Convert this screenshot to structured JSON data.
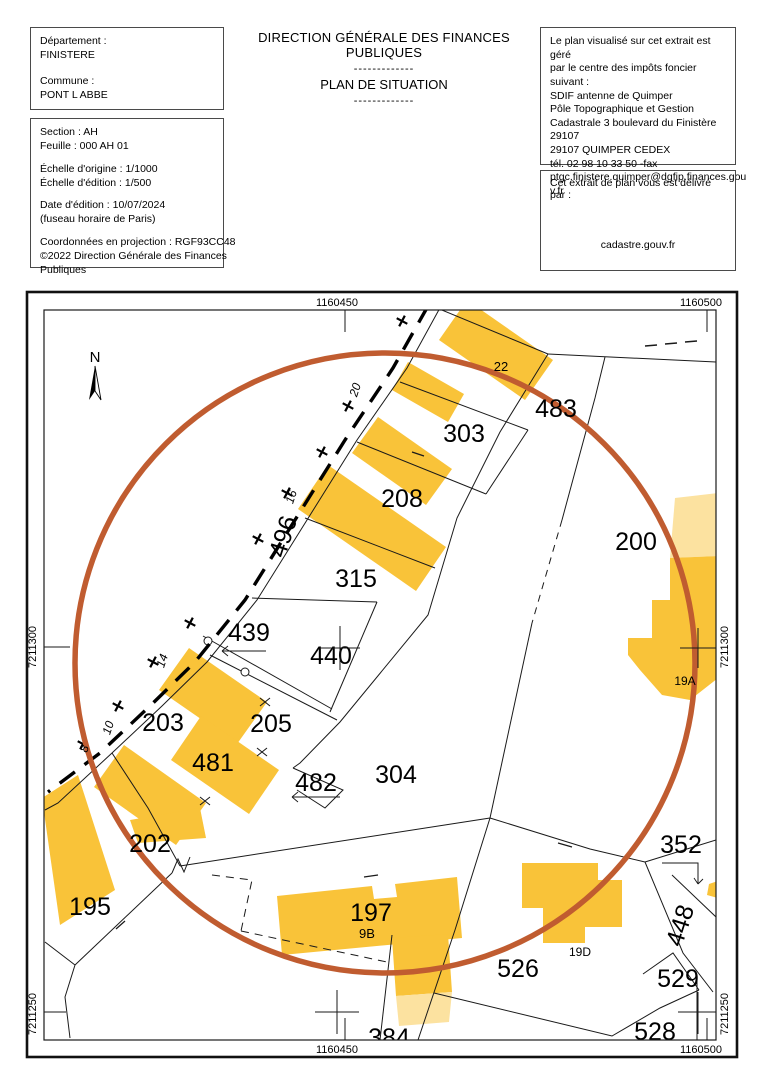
{
  "header": {
    "dept_box": {
      "dept_label": "Département :",
      "dept_value": "FINISTERE",
      "commune_label": "Commune :",
      "commune_value": "PONT L ABBE"
    },
    "info_box": {
      "section": "Section : AH",
      "feuille": "Feuille : 000 AH 01",
      "echelle_origine": "Échelle d'origine : 1/1000",
      "echelle_edition": "Échelle d'édition : 1/500",
      "date_edition": "Date d'édition : 10/07/2024",
      "fuseau": "(fuseau horaire de Paris)",
      "coordonnees": "Coordonnées en projection : RGF93CC48",
      "copyright1": "©2022 Direction Générale des Finances",
      "copyright2": "Publiques"
    },
    "title1": "DIRECTION GÉNÉRALE DES FINANCES PUBLIQUES",
    "separator1": "-------------",
    "title2": "PLAN DE SITUATION",
    "separator2": "-------------",
    "center_box": {
      "l1": "Le plan visualisé sur cet extrait est géré",
      "l2": "par le centre des impôts foncier suivant :",
      "l3": "SDIF antenne de Quimper",
      "l4": "Pôle Topographique et Gestion",
      "l5": "Cadastrale 3 boulevard du Finistère",
      "l6": "29107",
      "l7": "29107 QUIMPER CEDEX",
      "l8": "tél. 02 98 10 33 50 -fax",
      "l9": "ptgc.finistere.quimper@dgfip.finances.gou",
      "l10": "v.fr"
    },
    "delivery_box": {
      "label": "Cet extrait de plan vous est délivré par :",
      "provider": "cadastre.gouv.fr"
    }
  },
  "map": {
    "north_label": "N",
    "grid": {
      "top_left": "1160450",
      "top_right": "1160500",
      "bottom_left": "1160450",
      "bottom_right": "1160500",
      "left_top": "7211300",
      "left_bottom": "7211250",
      "right_top": "7211300",
      "right_bottom": "7211250"
    },
    "labels": {
      "l483": "483",
      "l303": "303",
      "l208": "208",
      "l315": "315",
      "l439": "439",
      "l440": "440",
      "l203": "203",
      "l205": "205",
      "l481": "481",
      "l482": "482",
      "l304": "304",
      "l202": "202",
      "l195": "195",
      "l197": "197",
      "l526": "526",
      "l200": "200",
      "l352": "352",
      "l529": "529",
      "l528": "528",
      "l384": "384",
      "l448": "448",
      "l496": "496",
      "l22": "22",
      "l9B": "9B",
      "l19D": "19D",
      "l19A": "19A"
    },
    "road_widths": {
      "w20": "20",
      "w16": "16",
      "w14": "14",
      "w10": "10",
      "w8": "8"
    },
    "colors": {
      "building": "#F9C339",
      "building_light": "#FCE2A0",
      "circle": "#C05C30",
      "line": "#1a1a1a"
    }
  }
}
